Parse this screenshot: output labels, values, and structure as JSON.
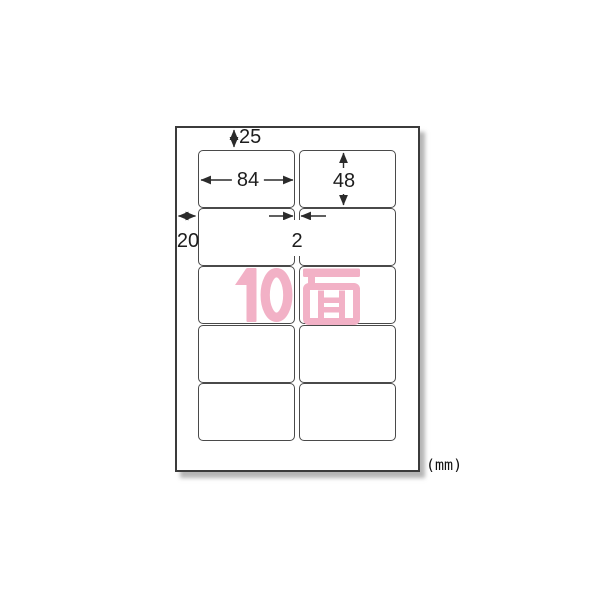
{
  "figure": {
    "kind": "label-sheet-dimension-diagram",
    "unit_note": "(mm)",
    "count_label": "10面",
    "accent_color": "#f2b1c6",
    "line_color": "#2b2b2b",
    "sheet": {
      "rows": 5,
      "columns": 2,
      "label_count": 10
    },
    "dimensions": {
      "top_margin": "25",
      "label_width": "84",
      "label_height": "48",
      "left_margin": "20",
      "column_gap": "2"
    }
  }
}
